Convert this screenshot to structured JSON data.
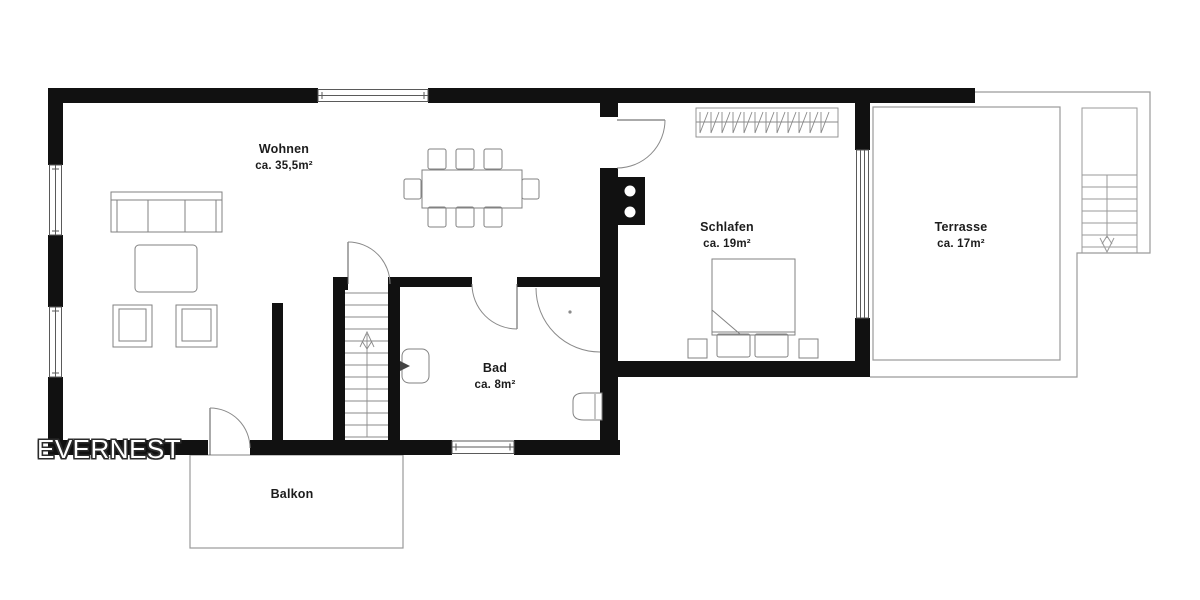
{
  "watermark": {
    "brand": "EVERNEST"
  },
  "plan": {
    "rooms": [
      {
        "id": "wohnen",
        "label": "Wohnen",
        "area": "ca. 35,5m²"
      },
      {
        "id": "schlafen",
        "label": "Schlafen",
        "area": "ca. 19m²"
      },
      {
        "id": "terrasse",
        "label": "Terrasse",
        "area": "ca. 17m²"
      },
      {
        "id": "bad",
        "label": "Bad",
        "area": "ca. 8m²"
      },
      {
        "id": "balkon",
        "label": "Balkon",
        "area": ""
      }
    ]
  },
  "colors": {
    "wall": "#111111",
    "outline": "#999999",
    "furniture": "#828282",
    "window_frame": "#5a5a5a",
    "label_text": "#1c1c1c",
    "background": "#ffffff",
    "watermark_text": "#ffffff"
  }
}
